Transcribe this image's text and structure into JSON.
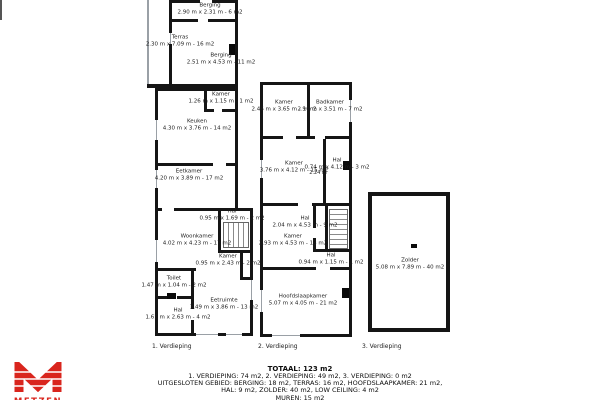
{
  "plans": [
    {
      "caption": "1. Verdieping",
      "rooms": [
        {
          "name": "Berging",
          "dims": "2.90 m x 2.31 m - 6 m2"
        },
        {
          "name": "Terras",
          "dims": "2.30 m x 7.09 m - 16 m2"
        },
        {
          "name": "Berging",
          "dims": "2.51 m x 4.53 m - 11 m2"
        },
        {
          "name": "Kamer",
          "dims": "1.26 m x 1.15 m - 1 m2"
        },
        {
          "name": "Keuken",
          "dims": "4.30 m x 3.76 m - 14 m2"
        },
        {
          "name": "Eetkamer",
          "dims": "4.20 m x 3.89 m - 17 m2"
        },
        {
          "name": "Hal",
          "dims": "0.95 m x 1.69 m - 2 m2"
        },
        {
          "name": "Woonkamer",
          "dims": "4.02 m x 4.23 m - 17 m2"
        },
        {
          "name": "Kamer",
          "dims": "0.95 m x 2.43 m - 2 m2"
        },
        {
          "name": "Toilet",
          "dims": "1.47 m x 1.04 m - 2 m2"
        },
        {
          "name": "Eetruimte",
          "dims": "3.49 m x 3.86 m - 13 m2"
        },
        {
          "name": "Hal",
          "dims": "1.61 m x 2.63 m - 4 m2"
        }
      ]
    },
    {
      "caption": "2. Verdieping",
      "annotation": "2.24 m",
      "rooms": [
        {
          "name": "Kamer",
          "dims": "2.46 m x 3.65 m - 9 m2"
        },
        {
          "name": "Badkamer",
          "dims": "2.10 m x 3.51 m - 7 m2"
        },
        {
          "name": "Kamer",
          "dims": "3.76 m x 4.12 m - 15 m2"
        },
        {
          "name": "Hal",
          "dims": "0.74 m x 4.12 m - 3 m2"
        },
        {
          "name": "Hal",
          "dims": "2.04 m x 4.53 m - 9 m2"
        },
        {
          "name": "Kamer",
          "dims": "2.93 m x 4.53 m - 13 m2"
        },
        {
          "name": "Hal",
          "dims": "0.94 m x 1.15 m - 1 m2"
        },
        {
          "name": "Hoofdslaapkamer",
          "dims": "5.07 m x 4.05 m - 21 m2"
        }
      ]
    },
    {
      "caption": "3. Verdieping",
      "rooms": [
        {
          "name": "Zolder",
          "dims": "5.08 m x 7.89 m - 40 m2"
        }
      ]
    }
  ],
  "summary": {
    "total": "TOTAAL: 123 m2",
    "line1": "1. VERDIEPING: 74 m2, 2. VERDIEPING: 49 m2, 3. VERDIEPING: 0 m2",
    "line2": "UITGESLOTEN GEBIED: BERGING: 18 m2, TERRAS: 16 m2, HOOFDSLAAPKAMER: 21 m2,",
    "line3": "HAL: 9 m2, ZOLDER: 40 m2, LOW CEILING: 4 m2",
    "line4": "MUREN: 15 m2"
  },
  "logo": {
    "text": "METZEN",
    "color": "#d9251d"
  },
  "colors": {
    "wall": "#151515",
    "window": "#9aa0a6",
    "accent_red": "#d9251d"
  }
}
